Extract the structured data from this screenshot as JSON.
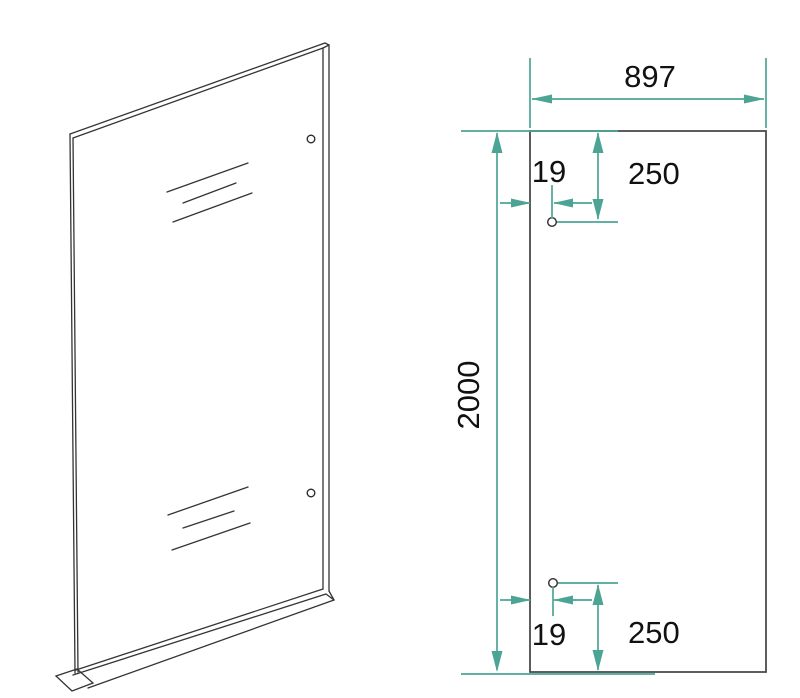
{
  "drawing": {
    "subject": "glass-panel-technical-drawing",
    "colors": {
      "outline": "#333434",
      "panel_stroke": "#4a4b4c",
      "dimension": "#4ca594",
      "text": "#111111",
      "background": "#ffffff"
    },
    "front_view": {
      "width_label": "897",
      "height_label": "2000",
      "top_hole": {
        "inset_label": "19",
        "drop_label": "250"
      },
      "bottom_hole": {
        "inset_label": "19",
        "rise_label": "250"
      }
    }
  }
}
